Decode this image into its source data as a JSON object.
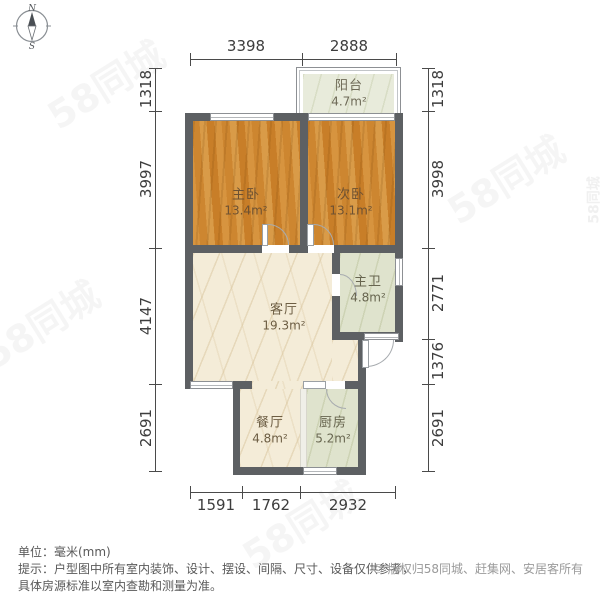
{
  "compass": {
    "north": "N",
    "south": "S"
  },
  "rooms": [
    {
      "id": "balcony",
      "name": "阳台",
      "area": "4.7m²"
    },
    {
      "id": "master-bedroom",
      "name": "主卧",
      "area": "13.4m²"
    },
    {
      "id": "second-bedroom",
      "name": "次卧",
      "area": "13.1m²"
    },
    {
      "id": "living-room",
      "name": "客厅",
      "area": "19.3m²"
    },
    {
      "id": "master-bathroom",
      "name": "主卫",
      "area": "4.8m²"
    },
    {
      "id": "dining-room",
      "name": "餐厅",
      "area": "4.8m²"
    },
    {
      "id": "kitchen",
      "name": "厨房",
      "area": "5.2m²"
    }
  ],
  "dimensions": {
    "top": [
      "3398",
      "2888"
    ],
    "left": [
      "1318",
      "3997",
      "4147",
      "2691"
    ],
    "right": [
      "1318",
      "3998",
      "2771",
      "1376",
      "2691"
    ],
    "bottom": [
      "1591",
      "1762",
      "2932"
    ]
  },
  "footer": {
    "unit_line": "单位：毫米(mm)",
    "note_line1": "提示：户型图中所有室内装饰、设计、摆设、间隔、尺寸、设备仅供参考，",
    "note_line2": "具体房源标准以室内查勘和测量为准。",
    "copyright": "© 版权归58同城、赶集网、安居客所有"
  },
  "watermark": {
    "text": "58同城"
  },
  "colors": {
    "wall": "#5d6063",
    "wood": "#d18a33",
    "marble": "#f4ecd8",
    "tile": "#dfe3cd",
    "dim_text": "#3d3d3d"
  }
}
